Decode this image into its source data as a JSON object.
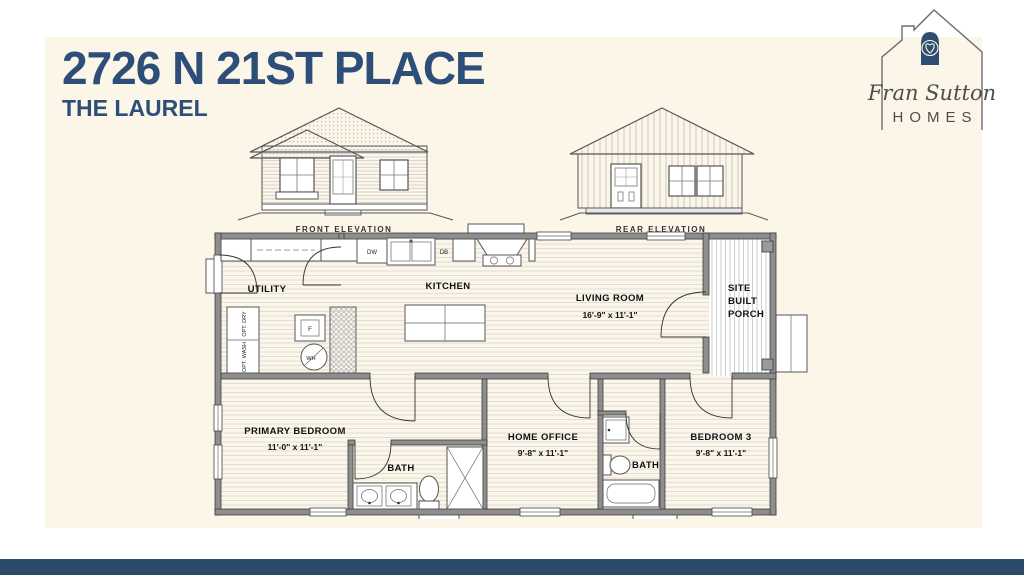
{
  "page": {
    "bg": "#ffffff",
    "panel_bg": "#fcf6e8",
    "bar_color": "#2e4a6a"
  },
  "header": {
    "title": "2726 N 21ST PLACE",
    "subtitle": "THE LAUREL",
    "title_color": "#2e4e7a"
  },
  "logo": {
    "script": "Fran Sutton",
    "caps": "HOMES",
    "door_color": "#2f4d70"
  },
  "elevations": {
    "front_label": "FRONT ELEVATION",
    "rear_label": "REAR ELEVATION"
  },
  "floorplan": {
    "utility": {
      "name": "UTILITY"
    },
    "kitchen": {
      "name": "KITCHEN"
    },
    "living": {
      "name": "LIVING ROOM",
      "dims": "16'-9\" x  11'-1\""
    },
    "porch": {
      "line1": "SITE",
      "line2": "BUILT",
      "line3": "PORCH"
    },
    "primary": {
      "name": "PRIMARY BEDROOM",
      "dims": "11'-0\" x  11'-1\""
    },
    "bath1": {
      "name": "BATH"
    },
    "office": {
      "name": "HOME OFFICE",
      "dims": "9'-8\" x  11'-1\""
    },
    "bath2": {
      "name": "BATH"
    },
    "bedroom3": {
      "name": "BEDROOM 3",
      "dims": "9'-8\" x  11'-1\""
    },
    "appliances": {
      "dw": "DW",
      "db": "DB",
      "fridge": "F",
      "water_heater": "WH",
      "opt_dry": "OPT. DRY",
      "opt_wash": "OPT. WASH"
    }
  }
}
